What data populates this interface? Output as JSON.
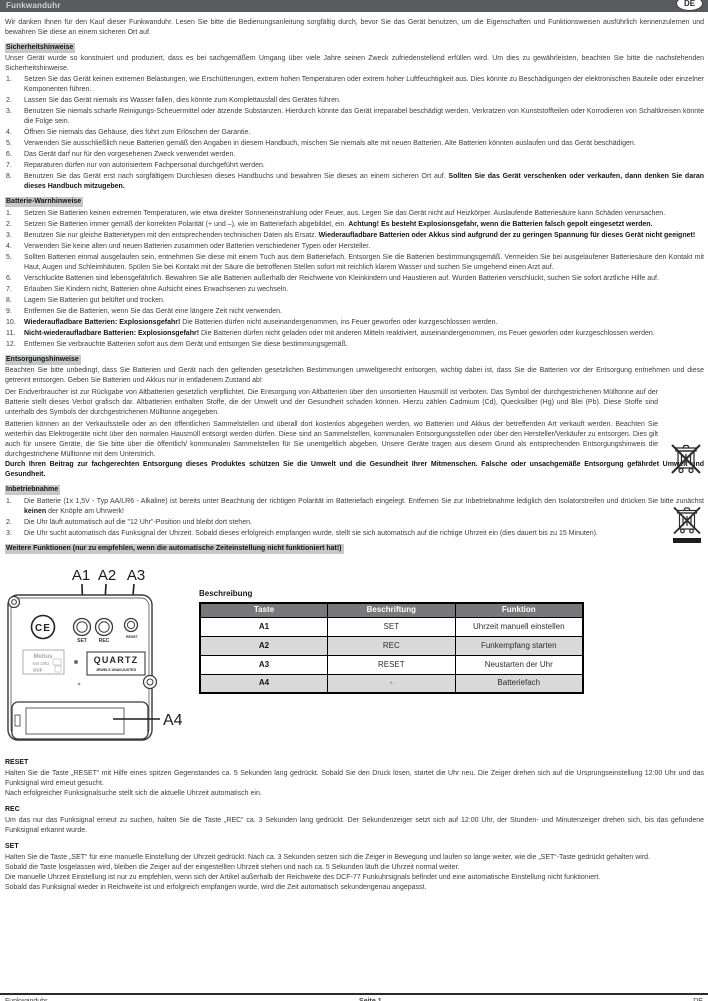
{
  "header": {
    "title": "Funkwanduhr",
    "lang_badge": "DE"
  },
  "intro": "Wir danken Ihnen für den Kauf dieser Funkwanduhr. Lesen Sie bitte die Bedienungsanleitung sorgfältig durch, bevor Sie das Gerät benutzen, um die Eigenschaften und Funktionsweisen ausführlich kennenzulernen und bewahren Sie diese an einem sicheren Ort auf.",
  "sicherheit": {
    "heading": "Sicherheitshinweise",
    "intro": "Unser Gerät wurde so konstruiert und produziert, dass es bei sachgemäßem Umgang über viele Jahre seinen Zweck zufriedenstellend erfüllen wird. Um dies zu gewährleisten, beachten Sie bitte die nachstehenden Sicherheitshinweise.",
    "items": [
      {
        "text": "Setzen Sie das Gerät keinen extremen Belastungen, wie Erschütterungen, extrem hohen Temperaturen oder extrem hoher Luftfeuchtigkeit aus. Dies könnte zu Beschädigungen der elektronischen Bauteile oder einzelner Komponenten führen."
      },
      {
        "text": "Lassen Sie das Gerät niemals ins Wasser fallen, dies könnte zum Komplettausfall des Gerätes führen."
      },
      {
        "text": "Benutzen Sie niemals scharfe Reinigungs-Scheuermittel oder ätzende Substanzen. Hierdurch könnte das Gerät irreparabel beschädigt werden. Verkratzen von Kunststoffteilen oder Korrodieren von Schaltkreisen könnte die Folge sein."
      },
      {
        "text": "Öffnen Sie niemals das Gehäuse, dies führt zum Erlöschen der Garantie."
      },
      {
        "text": "Verwenden Sie ausschließlich neue Batterien gemäß den Angaben in diesem Handbuch, mischen Sie niemals alte mit neuen Batterien. Alte Batterien könnten auslaufen und das Gerät beschädigen."
      },
      {
        "text": "Das Gerät darf nur für den vorgesehenen Zweck verwendet werden."
      },
      {
        "text": "Reparaturen dürfen nur von autorisiertem Fachpersonal durchgeführt werden."
      },
      {
        "text": "Benutzen Sie das Gerät erst nach sorgfältigem Durchlesen dieses Handbuchs und bewahren Sie dieses an einem sicheren Ort auf. ",
        "bold": "Sollten Sie das Gerät verschenken oder verkaufen, dann denken Sie daran dieses Handbuch mitzugeben."
      }
    ]
  },
  "batterie": {
    "heading": "Batterie-Warnhinweise",
    "items": [
      {
        "text": "Setzen Sie Batterien keinen extremen Temperaturen, wie etwa direkter Sonneneinstrahlung oder Feuer, aus. Legen Sie das Gerät nicht auf Heizkörper. Auslaufende Batteriesäure kann Schäden verursachen."
      },
      {
        "text": "Setzen Sie Batterien immer gemäß der korrekten Polarität (+ und –), wie im Batteriefach abgebildet, ein. ",
        "bold": "Achtung! Es besteht Explosionsgefahr, wenn die Batterien falsch gepolt eingesetzt werden."
      },
      {
        "text": "Benutzen Sie nur gleiche Batterietypen mit den entsprechenden technischen Daten als Ersatz. ",
        "bold": "Wiederaufladbare Batterien oder Akkus sind aufgrund der zu geringen Spannung für dieses Gerät nicht geeignet!"
      },
      {
        "text": "Verwenden Sie keine alten und neuen Batterien zusammen oder Batterien verschiedener Typen oder Hersteller."
      },
      {
        "text": "Sollten Batterien einmal ausgelaufen sein, entnehmen Sie diese mit einem Tuch aus dem Batteriefach. Entsorgen Sie die Batterien bestimmungsgemäß. Vermeiden Sie bei ausgelaufener Batteriesäure den Kontakt mit Haut, Augen und Schleimhäuten. Spülen Sie bei Kontakt mit der Säure die betroffenen Stellen sofort mit reichlich klarem Wasser und suchen Sie umgehend einen Arzt auf."
      },
      {
        "text": "Verschluckte Batterien sind lebensgefährlich. Bewahren Sie alle Batterien außerhalb der Reichweite von Kleinkindern und Haustieren auf. Wurden Batterien verschluckt, suchen Sie sofort ärztliche Hilfe auf."
      },
      {
        "text": "Erlauben Sie Kindern nicht, Batterien ohne Aufsicht eines Erwachsenen zu wechseln."
      },
      {
        "text": "Lagern Sie Batterien gut belüftet und trocken."
      },
      {
        "text": "Entfernen Sie die Batterien, wenn Sie das Gerät eine längere Zeit nicht verwenden."
      },
      {
        "bold_lead": "Wiederaufladbare Batterien: Explosionsgefahr!",
        "text": " Die Batterien dürfen nicht auseinandergenommen, ins Feuer geworfen oder kurzgeschlossen werden."
      },
      {
        "bold_lead": "Nicht-wiederaufladbare Batterien: Explosionsgefahr!",
        "text": " Die Batterien dürfen nicht geladen oder mit anderen Mitteln reaktiviert, auseinandergenommen, ins Feuer geworfen oder kurzgeschlossen werden."
      },
      {
        "text": "Entfernen Sie verbrauchte Batterien sofort aus dem Gerät und entsorgen Sie diese bestimmungsgemäß."
      }
    ]
  },
  "entsorgung": {
    "heading": "Entsorgungshinweise",
    "p1": "Beachten Sie bitte unbedingt, dass Sie Batterien und Gerät nach den geltenden gesetzlichen Bestimmungen umweltgerecht entsorgen, wichtig dabei ist, dass Sie die Batterien vor der Entsorgung entnehmen und diese getrennt entsorgen. Geben Sie Batterien und Akkus nur in entladenem Zustand ab!",
    "p2": "Der Endverbraucher ist zur Rückgabe von Altbatterien gesetzlich verpflichtet. Die Entsorgung von Altbatterien über den unsortierten Hausmüll ist verboten. Das Symbol der durchgestrichenen Mülltonne auf der Batterie stellt dieses Verbot grafisch dar. Altbatterien enthalten Stoffe, die der Umwelt und der Gesundheit schaden können. Hierzu zählen Cadmium (Cd), Quecksilber (Hg) und Blei (Pb). Diese Stoffe sind unterhalb des Symbols der durchgestrichenen Mülltonne angegeben.",
    "p3": "Batterien können an der Verkaufsstelle oder an den öffentlichen Sammelstellen und überall dort kostenlos abgegeben werden, wo Batterien und Akkus der betreffenden Art verkauft werden. Beachten Sie weiterhin das Elektrogeräte nicht über den normalen Hausmüll entsorgt werden dürfen. Diese sind an Sammelstellen, kommunalen Entsorgungsstellen oder über den Hersteller/Verkäufer zu entsorgen. Dies gilt auch für unsere Geräte, die Sie bitte über die öffentlich/ kommunalen Sammelstellen für Sie unentgeltlich abgeben. Unsere Geräte tragen aus diesem Grund als entsprechenden Entsorgungshinweis die durchgestrichene Mülltonne mit dem Unterstrich.",
    "p4_bold": "Durch Ihren Beitrag zur fachgerechten Entsorgung dieses Produktes schützen Sie die Umwelt und die Gesundheit Ihrer Mitmenschen. Falsche oder unsachgemäße Entsorgung gefährdet Umwelt und Gesundheit."
  },
  "inbetriebnahme": {
    "heading": "Inbetriebnahme",
    "items": [
      {
        "text": "Die Batterie (1x 1,5V - Typ AA/LR6 - Alkaline) ist bereits unter Beachtung der richtigen Polarität im Batteriefach eingelegt. Entfernen Sie zur Inbetriebnahme lediglich den Isolatorstreifen und drücken Sie bitte zunächst ",
        "bold": "keinen",
        "text2": " der Knöpfe am Uhrwerk!"
      },
      {
        "text": "Die Uhr läuft automatisch auf die \"12 Uhr\"-Position und bleibt dort stehen."
      },
      {
        "text": "Die Uhr sucht automatisch das Funksignal der Uhrzeit. Sobald dieses erfolgreich empfangen wurde, stellt sie sich automatisch auf die richtige Uhrzeit ein (dies dauert bis zu 15 Minuten)."
      }
    ]
  },
  "weitere": {
    "heading": "Weitere Funktionen (nur zu empfehlen, wenn die automatische Zeiteinstellung nicht funktioniert hat!)"
  },
  "diagram": {
    "a1": "A1",
    "a2": "A2",
    "a3": "A3",
    "a4": "A4",
    "set": "SET",
    "rec": "REC",
    "reset": "RESET",
    "ce": "CE",
    "quartz": "QUARTZ",
    "quartz_sub": "JEWELS UNADJUSTED",
    "brand": "Mebus",
    "brand_sub": "seit 1902",
    "brand_dcf": "DCF"
  },
  "table": {
    "caption": "Beschreibung",
    "headers": [
      "Taste",
      "Beschriftung",
      "Funktion"
    ],
    "rows": [
      [
        "A1",
        "SET",
        "Uhrzeit manuell einstellen"
      ],
      [
        "A2",
        "REC",
        "Funkempfang starten"
      ],
      [
        "A3",
        "RESET",
        "Neustarten der Uhr"
      ],
      [
        "A4",
        "-",
        "Batteriefach"
      ]
    ]
  },
  "reset_section": {
    "heading": "RESET",
    "p1": "Halten Sie die Taste „RESET“ mit Hilfe eines spitzen Gegenstandes ca. 5 Sekunden lang gedrückt. Sobald Sie den Druck lösen, startet die Uhr neu. Die Zeiger drehen sich auf die Ursprungseinstellung 12:00 Uhr und das Funksignal wird erneut gesucht.",
    "p2": "Nach erfolgreicher Funksignalsuche stellt sich die aktuelle Uhrzeit automatisch ein."
  },
  "rec_section": {
    "heading": "REC",
    "p1": "Um das nur das Funksignal erneut zu suchen, halten Sie die Taste „REC“ ca. 3 Sekunden lang gedrückt. Der Sekundenzeiger setzt sich auf 12:00 Uhr, der Stunden- und Minutenzeiger drehen sich, bis das gefundene Funksignal erkannt wurde."
  },
  "set_section": {
    "heading": "SET",
    "p1": "Halten Sie die Taste „SET“ für eine manuelle Einstellung der Uhrzeit gedrückt. Nach ca. 3 Sekunden setzen sich die Zeiger in Bewegung und laufen so lange weiter, wie die „SET“-Taste gedrückt gehalten wird.",
    "p2": "Sobald die Taste losgelassen wird, bleiben die Zeiger auf der eingestellten Uhrzeit stehen und nach ca. 5 Sekunden läuft die Uhrzeit normal weiter.",
    "p3": "Die manuelle Uhrzeit Einstellung ist nur zu empfehlen, wenn sich der Artikel außerhalb der Reichweite des DCF-77 Funkuhrsignals befindet und eine automatische Einstellung nicht funktioniert.",
    "p4": "Sobald das Funksignal wieder in Reichweite ist und erfolgreich empfangen wurde, wird die Zeit automatisch sekundengenau angepasst."
  },
  "footer": {
    "left": "Funkwanduhr",
    "center": "Seite 1",
    "right": "DE"
  }
}
